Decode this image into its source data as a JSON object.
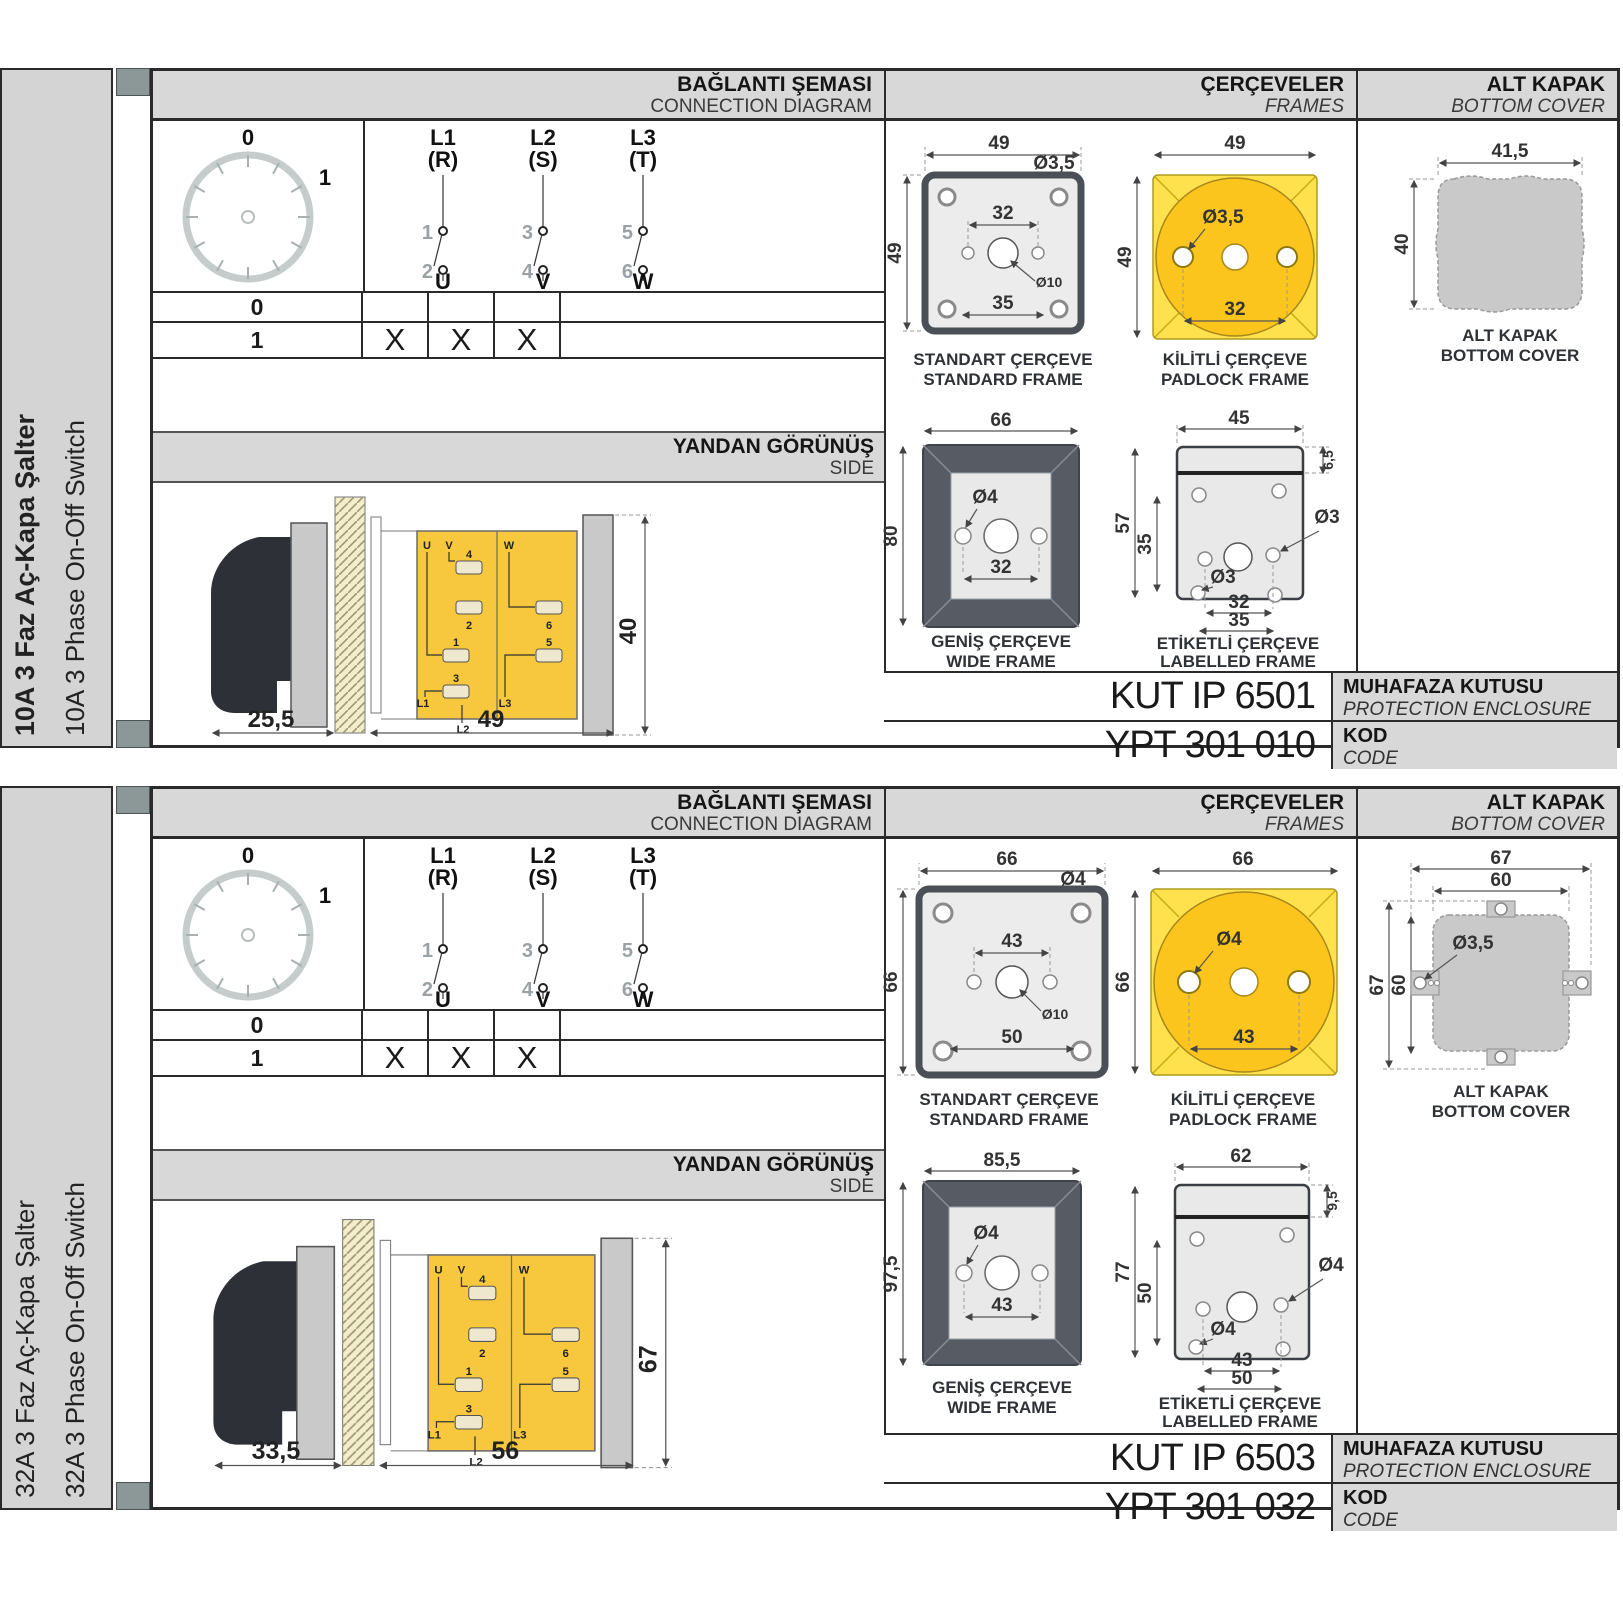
{
  "colors": {
    "header_gray": "#d8d8d8",
    "sidebar_gray": "#d4d4d4",
    "tab_square": "#8c9898",
    "body_yellow": "#f7c83d",
    "padlock_yellow": "#ffe14d",
    "padlock_circle": "#fcc51e",
    "frame_fill": "#ececec",
    "wide_frame_dark": "#575c64",
    "cover_gray": "#c9c9c9",
    "line_dark": "#2a2a2a"
  },
  "shared": {
    "headers": {
      "connection_tr": "BAĞLANTI ŞEMASI",
      "connection_en": "CONNECTION DIAGRAM",
      "frames_tr": "ÇERÇEVELER",
      "frames_en": "FRAMES",
      "cover_tr": "ALT KAPAK",
      "cover_en": "BOTTOM COVER",
      "side_tr": "YANDAN GÖRÜNÜŞ",
      "side_en": "SIDE",
      "enclosure_tr": "MUHAFAZA KUTUSU",
      "enclosure_en": "PROTECTION ENCLOSURE",
      "code_tr": "KOD",
      "code_en": "CODE"
    },
    "dial": {
      "zero": "0",
      "one": "1"
    },
    "poles": [
      {
        "line": "L1",
        "phase": "(R)",
        "cin": "1",
        "cout": "2",
        "term": "U"
      },
      {
        "line": "L2",
        "phase": "(S)",
        "cin": "3",
        "cout": "4",
        "term": "V"
      },
      {
        "line": "L3",
        "phase": "(T)",
        "cin": "5",
        "cout": "6",
        "term": "W"
      }
    ],
    "truth": {
      "rows": [
        {
          "pos": "0",
          "marks": [
            "",
            "",
            ""
          ]
        },
        {
          "pos": "1",
          "marks": [
            "X",
            "X",
            "X"
          ]
        }
      ]
    },
    "captions": {
      "standard_tr": "STANDART ÇERÇEVE",
      "standard_en": "STANDARD FRAME",
      "padlock_tr": "KİLİTLİ ÇERÇEVE",
      "padlock_en": "PADLOCK FRAME",
      "wide_tr": "GENİŞ ÇERÇEVE",
      "wide_en": "WIDE FRAME",
      "labelled_tr": "ETİKETLİ ÇERÇEVE",
      "labelled_en": "LABELLED FRAME",
      "cover_tr": "ALT KAPAK",
      "cover_en": "BOTTOM COVER"
    },
    "side_terms": {
      "u": "U",
      "v": "V",
      "w": "W",
      "n4": "4",
      "n2": "2",
      "n6": "6",
      "n1": "1",
      "n5": "5",
      "n3": "3",
      "l1": "L1",
      "l2": "L2",
      "l3": "L3"
    }
  },
  "sections": [
    {
      "title_tr": "10A 3 Faz Aç-Kapa Şalter",
      "title_en": "10A 3 Phase On-Off Switch",
      "side_view": {
        "depth": "25,5",
        "width": "49",
        "height": "40"
      },
      "standard": {
        "w": "49",
        "h": "49",
        "hole": "Ø3,5",
        "span_top": "32",
        "center": "Ø10",
        "span_bottom": "35"
      },
      "padlock": {
        "w": "49",
        "h": "49",
        "hole": "Ø3,5",
        "span": "32"
      },
      "wide": {
        "w": "66",
        "h": "80",
        "hole": "Ø4",
        "span": "32"
      },
      "labelled": {
        "w": "45",
        "h": "57",
        "inner": "35",
        "strip": "6,5",
        "hole_side": "Ø3",
        "hole_bottom": "Ø3",
        "span1": "32",
        "span2": "35"
      },
      "cover": {
        "w": "41,5",
        "h": "40"
      },
      "codes": {
        "enclosure": "KUT IP 6501",
        "code": "YPT 301 010"
      }
    },
    {
      "title_tr": "32A 3 Faz Aç-Kapa Şalter",
      "title_en": "32A 3 Phase On-Off Switch",
      "side_view": {
        "depth": "33,5",
        "width": "56",
        "height": "67"
      },
      "standard": {
        "w": "66",
        "h": "66",
        "hole": "Ø4",
        "span_top": "43",
        "center": "Ø10",
        "span_bottom": "50"
      },
      "padlock": {
        "w": "66",
        "h": "66",
        "hole": "Ø4",
        "span": "43"
      },
      "wide": {
        "w": "85,5",
        "h": "97,5",
        "hole": "Ø4",
        "span": "43"
      },
      "labelled": {
        "w": "62",
        "h": "77",
        "inner": "50",
        "strip": "9,5",
        "hole_side": "Ø4",
        "hole_bottom": "Ø4",
        "span1": "43",
        "span2": "50"
      },
      "cover": {
        "outer_w": "67",
        "inner_w": "60",
        "outer_h": "67",
        "inner_h": "60",
        "hole": "Ø3,5"
      },
      "codes": {
        "enclosure": "KUT IP 6503",
        "code": "YPT 301 032"
      }
    }
  ]
}
